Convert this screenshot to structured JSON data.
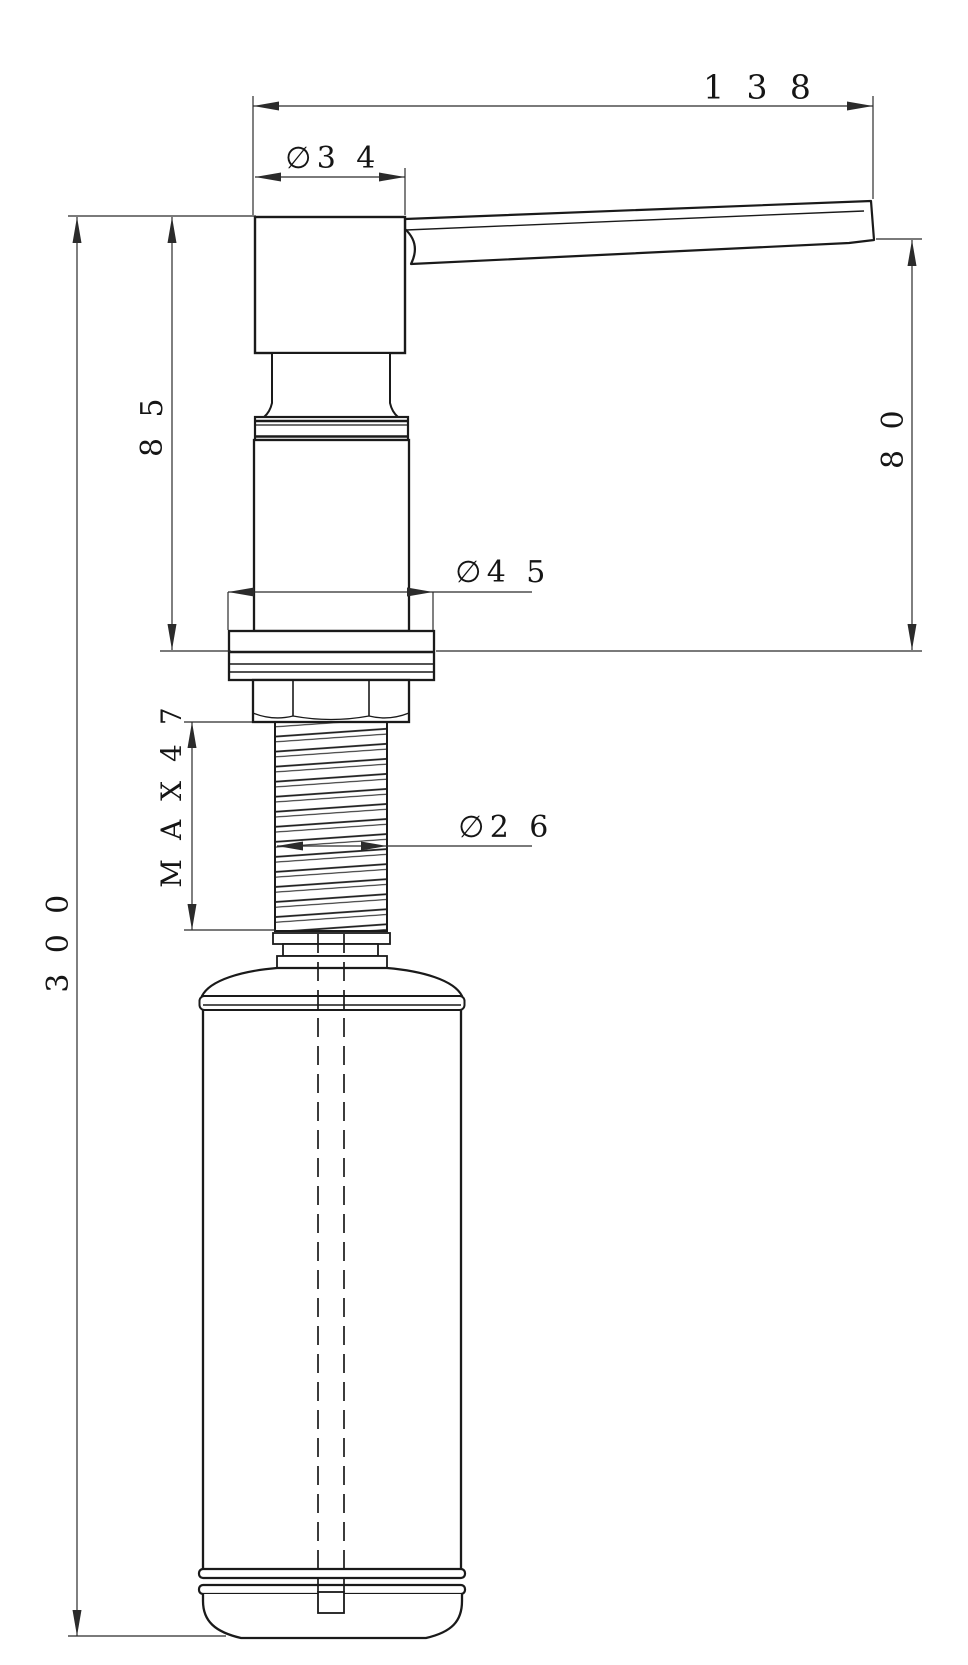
{
  "colors": {
    "background": "#ffffff",
    "outline": "#1a1a1a",
    "dimension": "#2b2b2b",
    "text": "#151515"
  },
  "drawing": {
    "type": "technical-drawing",
    "subject": "soap-dispenser-side-view",
    "labels": {
      "overall_length": "1 3 8",
      "head_diameter": "∅3 4",
      "pump_upper_height": "8 5",
      "spout_height": "8 0",
      "flange_diameter": "∅4 5",
      "thread_max_length": "M A X 4 7",
      "thread_diameter": "∅2 6",
      "overall_height": "3 0 0"
    }
  }
}
